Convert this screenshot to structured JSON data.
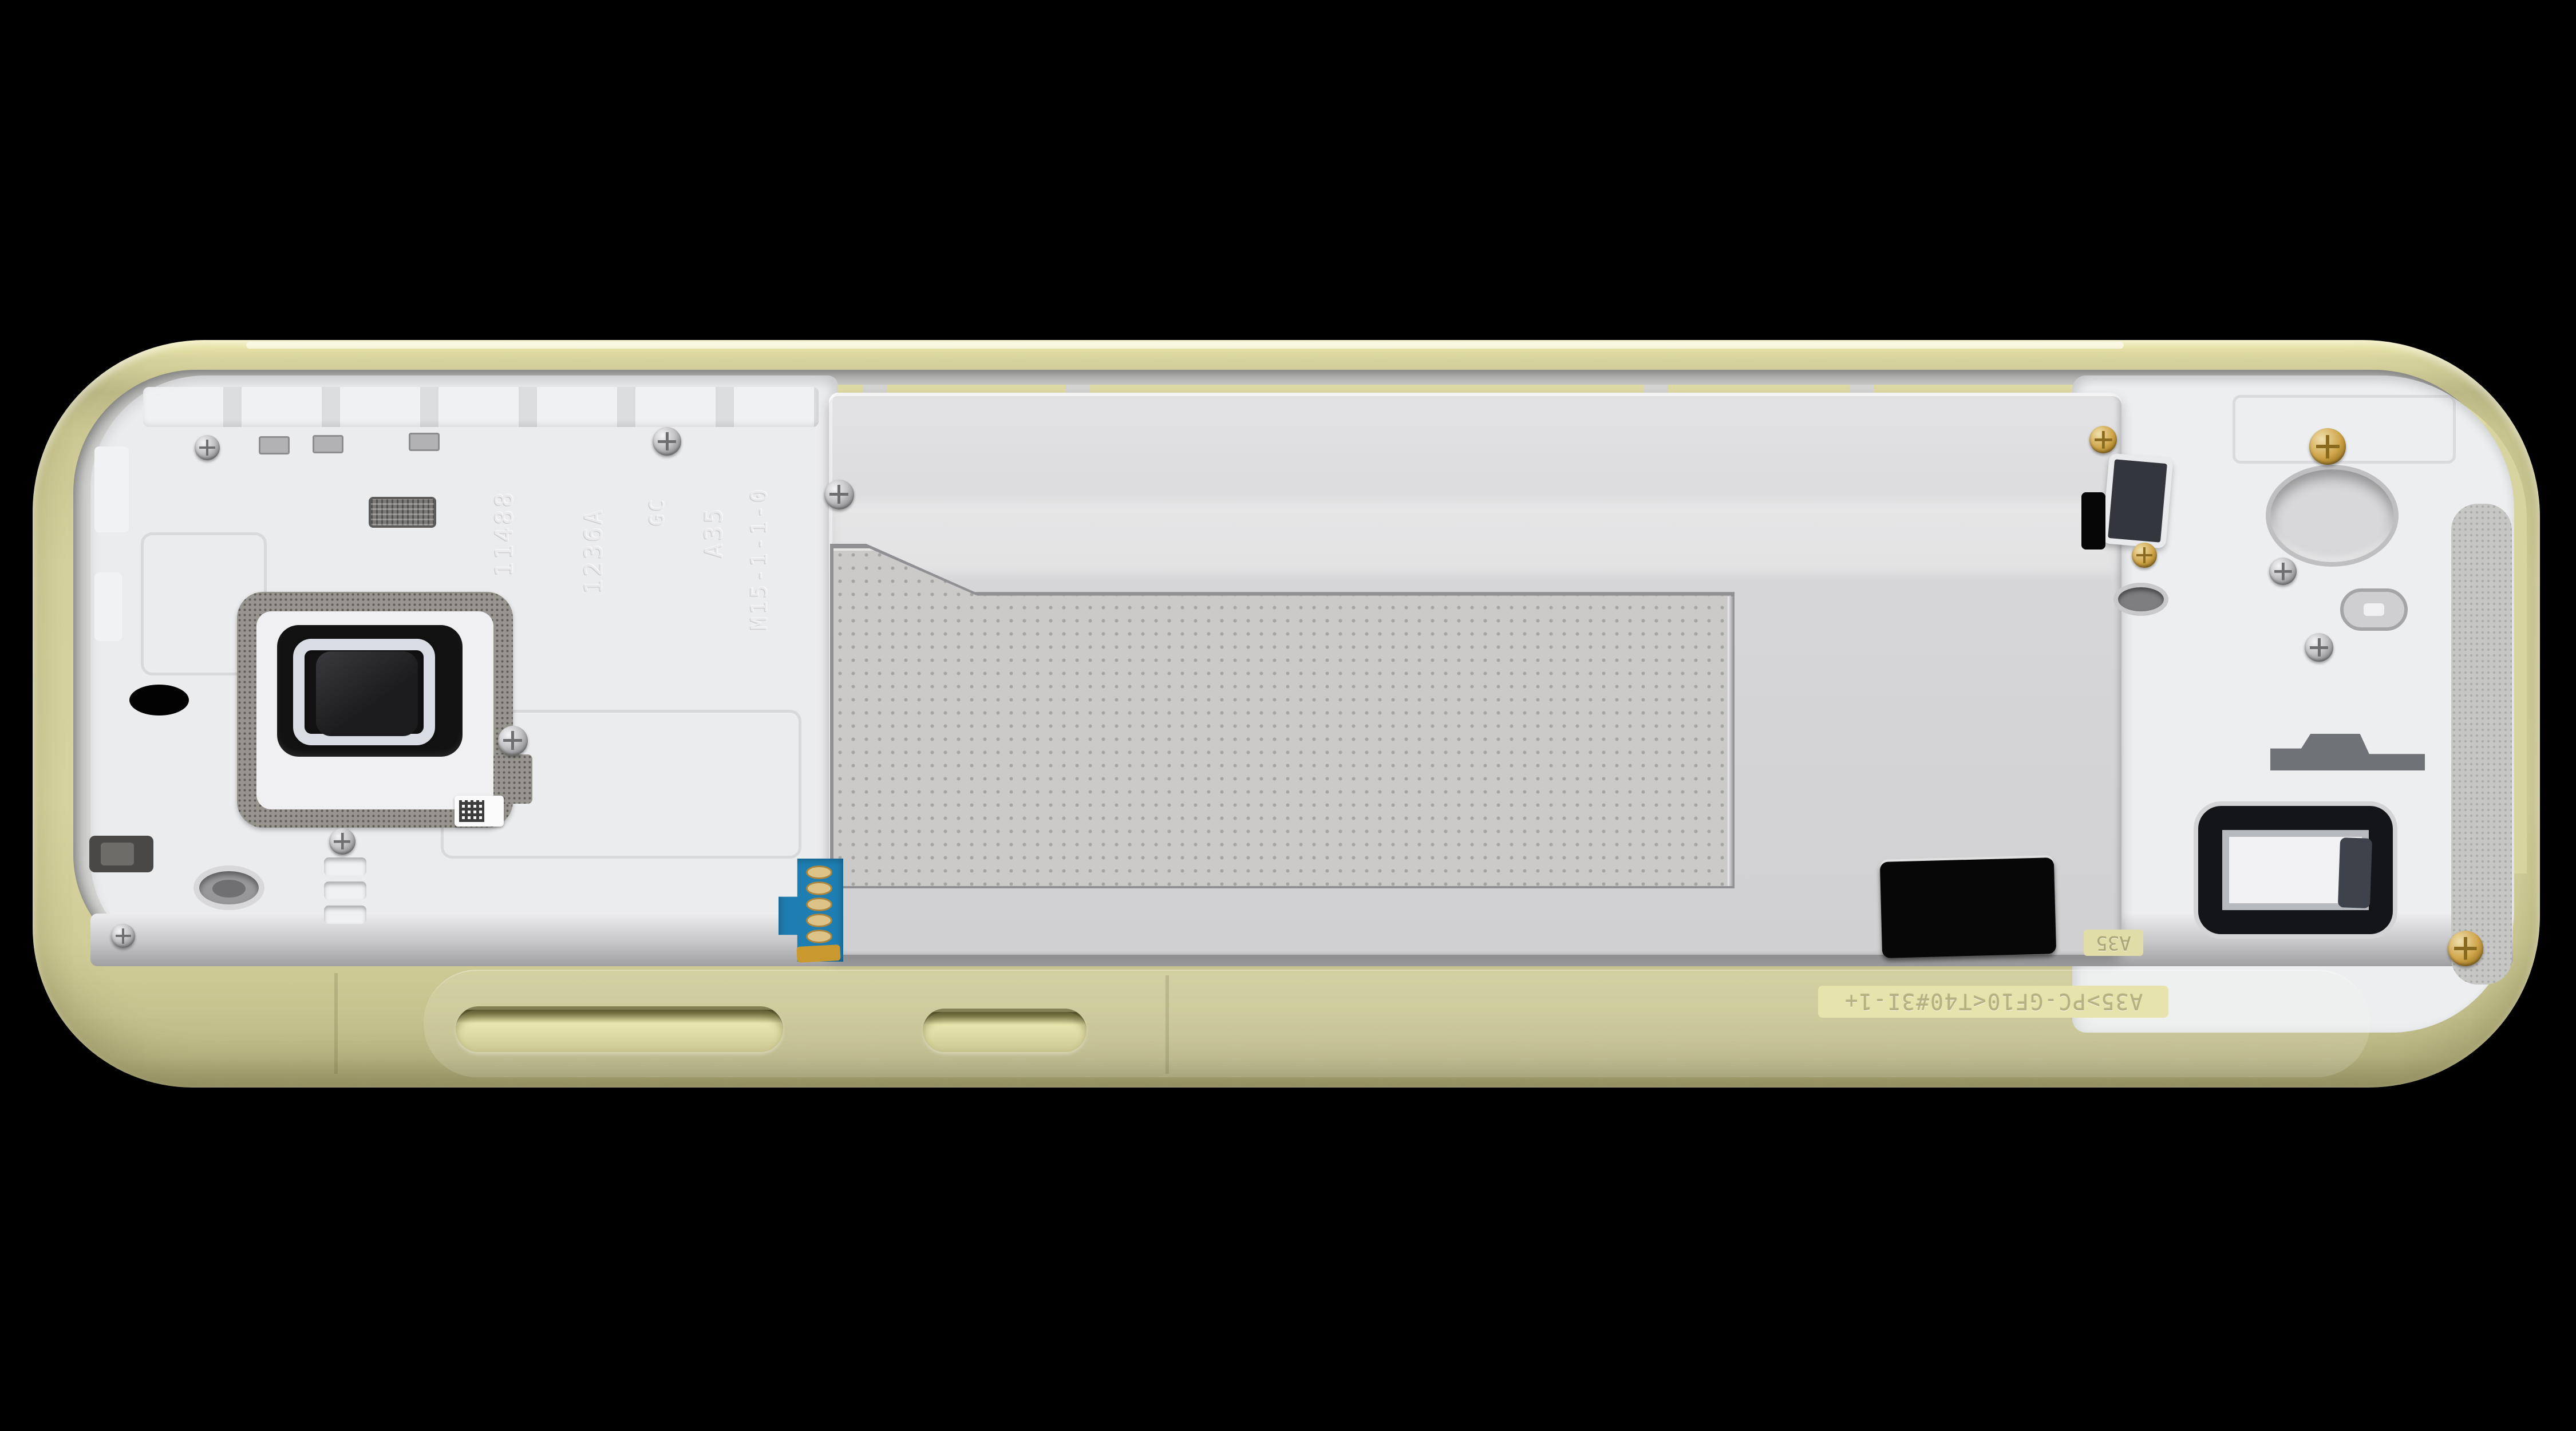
{
  "scene": {
    "subject": "Smartphone mid-frame chassis photographed from the inside, lying on a black background",
    "background_color": "#000000",
    "frame_color_name": "pale lime yellow",
    "frame_color_hex": "#d4d19b",
    "plate_color_hex": "#d3d3d5",
    "plastic_color_hex": "#edeef0"
  },
  "markings": {
    "engraved_codes": [
      "11488",
      "1236A",
      "GC",
      "A35",
      "M15-1-1-0"
    ],
    "material_strip": "A35>PC-GF10<T40#3I-1+",
    "side_label": "A35"
  },
  "components": {
    "camera-cutout": "main camera opening with foam gasket, black bezel, metal ring and lens window",
    "qr-sticker": "small data-matrix serial sticker",
    "speaker-mesh": "metal mesh pad",
    "battery-flex-connector": "blue flex PCB with five gold contact pads",
    "volume-button-slot": "recessed volume button pocket on frame edge",
    "power-button-slot": "recessed power button pocket on frame edge",
    "battery-tray-plate": "dimpled battery/NFC antenna plate",
    "flash-window": "dark rectangular flash/sensor window",
    "loudspeaker-window": "black-gasket loudspeaker opening",
    "screws": "silver and gold philips screws",
    "through-hole": "oval through-hole showing background",
    "mic-hole": "circular port hole",
    "material-strip": "embossed plastic material code strip"
  },
  "colors": {
    "flex_blue": "#1f7eb1",
    "contact_gold": "#dcc488",
    "screw_gold": "#cfa54a",
    "gasket_gray": "#98958f",
    "camera_black": "#121212"
  }
}
